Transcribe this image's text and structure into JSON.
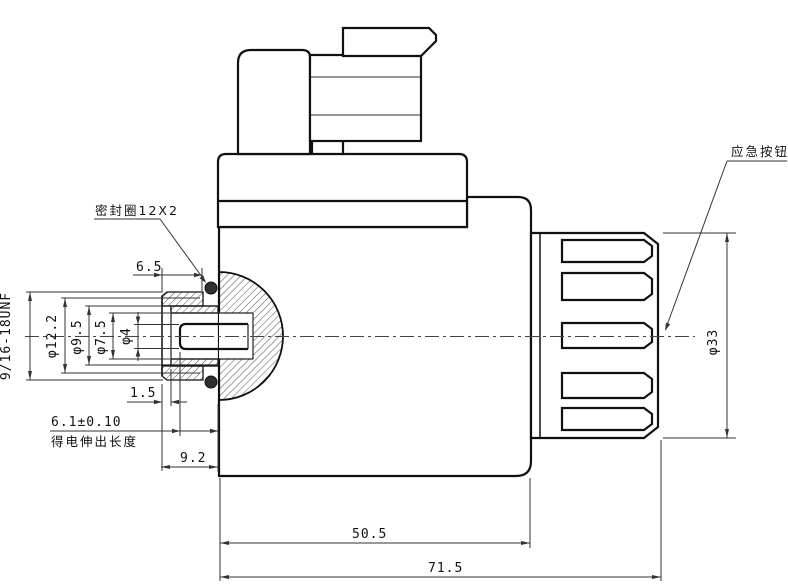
{
  "drawing": {
    "annotations": {
      "seal_ring": "密封圈12X2",
      "emergency_button": "应急按钮",
      "extension_note": "得电伸出长度"
    },
    "dimensions": {
      "thread_spec": "9/16-18UNF",
      "dia_12_2": "φ12.2",
      "dia_9_5": "φ9.5",
      "dia_7_5": "φ7.5",
      "dia_4": "φ4",
      "dia_33": "φ33",
      "len_6_5": "6.5",
      "len_1_5": "1.5",
      "len_6_1": "6.1±0.10",
      "len_9_2": "9.2",
      "len_50_5": "50.5",
      "len_71_5": "71.5"
    },
    "colors": {
      "line": "#111111",
      "dim_line": "#333333",
      "background": "#ffffff",
      "oring_fill": "#2f2f2f"
    }
  }
}
